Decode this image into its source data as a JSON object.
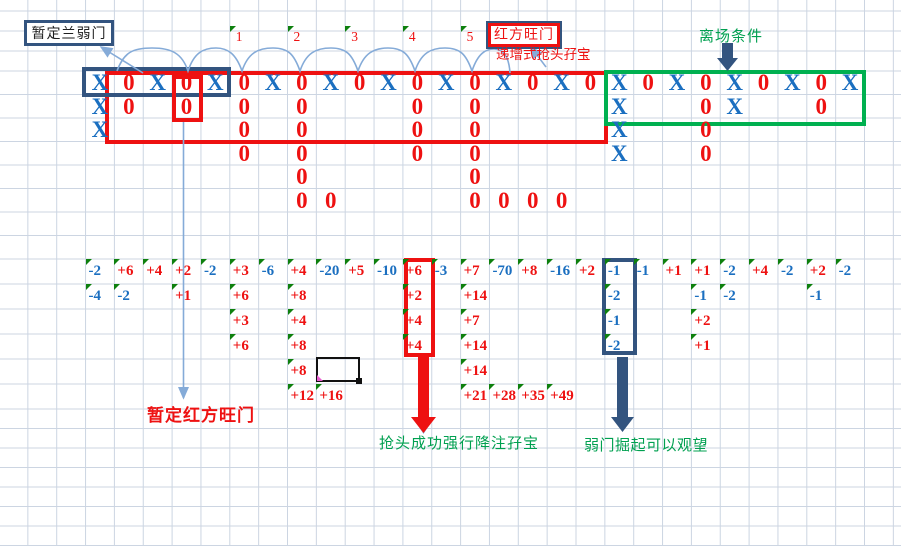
{
  "colors": {
    "x_blue": "#1b6fc0",
    "o_red": "#ee1111",
    "green_text": "#00a050",
    "green_box": "#00b050",
    "tri_green": "#0e800e",
    "navy": "#33547f",
    "light_blue": "#85abd8",
    "grid": "#ccd5e2"
  },
  "labels": {
    "tentative_weak_box": "暂定兰弱门",
    "red_strong_box": "红方旺门",
    "incremental_note": "递增式抢头孖宝",
    "exit_condition": "离场条件",
    "tentative_red": "暂定红方旺门",
    "grab_head_note": "抢头成功强行降注孖宝",
    "weak_rise_note": "弱门掘起可以观望"
  },
  "top_labels": [
    [
      5,
      "1"
    ],
    [
      7,
      "2"
    ],
    [
      9,
      "3"
    ],
    [
      11,
      "4"
    ],
    [
      13,
      "5"
    ]
  ],
  "xo_left": {
    "rows": [
      [
        [
          0,
          "X"
        ],
        [
          1,
          "0"
        ],
        [
          2,
          "X"
        ],
        [
          3,
          "0"
        ],
        [
          4,
          "X"
        ],
        [
          5,
          "0"
        ],
        [
          6,
          "X"
        ],
        [
          7,
          "0"
        ],
        [
          8,
          "X"
        ],
        [
          9,
          "0"
        ],
        [
          10,
          "X"
        ],
        [
          11,
          "0"
        ],
        [
          12,
          "X"
        ],
        [
          13,
          "0"
        ],
        [
          14,
          "X"
        ],
        [
          15,
          "0"
        ],
        [
          16,
          "X"
        ],
        [
          17,
          "0"
        ]
      ],
      [
        [
          0,
          "X"
        ],
        [
          1,
          "0"
        ],
        [
          3,
          "0"
        ],
        [
          5,
          "0"
        ],
        [
          7,
          "0"
        ],
        [
          11,
          "0"
        ],
        [
          13,
          "0"
        ]
      ],
      [
        [
          0,
          "X"
        ],
        [
          5,
          "0"
        ],
        [
          7,
          "0"
        ],
        [
          11,
          "0"
        ],
        [
          13,
          "0"
        ]
      ],
      [
        [
          5,
          "0"
        ],
        [
          7,
          "0"
        ],
        [
          11,
          "0"
        ],
        [
          13,
          "0"
        ]
      ],
      [
        [
          7,
          "0"
        ],
        [
          13,
          "0"
        ]
      ],
      [
        [
          7,
          "0"
        ],
        [
          8,
          "0"
        ],
        [
          13,
          "0"
        ],
        [
          14,
          "0"
        ],
        [
          15,
          "0"
        ],
        [
          16,
          "0"
        ]
      ]
    ]
  },
  "xo_right": {
    "rows": [
      [
        [
          0,
          "X"
        ],
        [
          1,
          "0"
        ],
        [
          2,
          "X"
        ],
        [
          3,
          "0"
        ],
        [
          4,
          "X"
        ],
        [
          5,
          "0"
        ],
        [
          6,
          "X"
        ],
        [
          7,
          "0"
        ],
        [
          8,
          "X"
        ]
      ],
      [
        [
          0,
          "X"
        ],
        [
          3,
          "0"
        ],
        [
          4,
          "X"
        ],
        [
          7,
          "0"
        ]
      ],
      [
        [
          0,
          "X"
        ],
        [
          3,
          "0"
        ]
      ],
      [
        [
          0,
          "X"
        ],
        [
          3,
          "0"
        ]
      ]
    ]
  },
  "numbers": {
    "rows": [
      [
        [
          0,
          "-2"
        ],
        [
          1,
          "+6"
        ],
        [
          2,
          "+4"
        ],
        [
          3,
          "+2"
        ],
        [
          4,
          "-2"
        ],
        [
          5,
          "+3"
        ],
        [
          6,
          "-6"
        ],
        [
          7,
          "+4"
        ],
        [
          8,
          "-20"
        ],
        [
          9,
          "+5"
        ],
        [
          10,
          "-10"
        ],
        [
          11,
          "+6"
        ],
        [
          12,
          "-3"
        ],
        [
          13,
          "+7"
        ],
        [
          14,
          "-70"
        ],
        [
          15,
          "+8"
        ],
        [
          16,
          "-16"
        ],
        [
          17,
          "+2"
        ],
        [
          18,
          "-1"
        ],
        [
          19,
          "-1"
        ],
        [
          20,
          "+1"
        ],
        [
          21,
          "+1"
        ],
        [
          22,
          "-2"
        ],
        [
          23,
          "+4"
        ],
        [
          24,
          "-2"
        ],
        [
          25,
          "+2"
        ],
        [
          26,
          "-2"
        ]
      ],
      [
        [
          0,
          "-4"
        ],
        [
          1,
          "-2"
        ],
        [
          3,
          "+1"
        ],
        [
          5,
          "+6"
        ],
        [
          7,
          "+8"
        ],
        [
          11,
          "+2"
        ],
        [
          13,
          "+14"
        ],
        [
          18,
          "-2"
        ],
        [
          21,
          "-1"
        ],
        [
          22,
          "-2"
        ],
        [
          25,
          "-1"
        ]
      ],
      [
        [
          5,
          "+3"
        ],
        [
          7,
          "+4"
        ],
        [
          11,
          "+4"
        ],
        [
          13,
          "+7"
        ],
        [
          18,
          "-1"
        ],
        [
          21,
          "+2"
        ]
      ],
      [
        [
          5,
          "+6"
        ],
        [
          7,
          "+8"
        ],
        [
          11,
          "+4"
        ],
        [
          13,
          "+14"
        ],
        [
          18,
          "-2"
        ],
        [
          21,
          "+1"
        ]
      ],
      [
        [
          7,
          "+8"
        ],
        [
          13,
          "+14"
        ]
      ],
      [
        [
          7,
          "+12"
        ],
        [
          8,
          "+16"
        ],
        [
          13,
          "+21"
        ],
        [
          14,
          "+28"
        ],
        [
          15,
          "+35"
        ],
        [
          16,
          "+49"
        ]
      ]
    ]
  }
}
